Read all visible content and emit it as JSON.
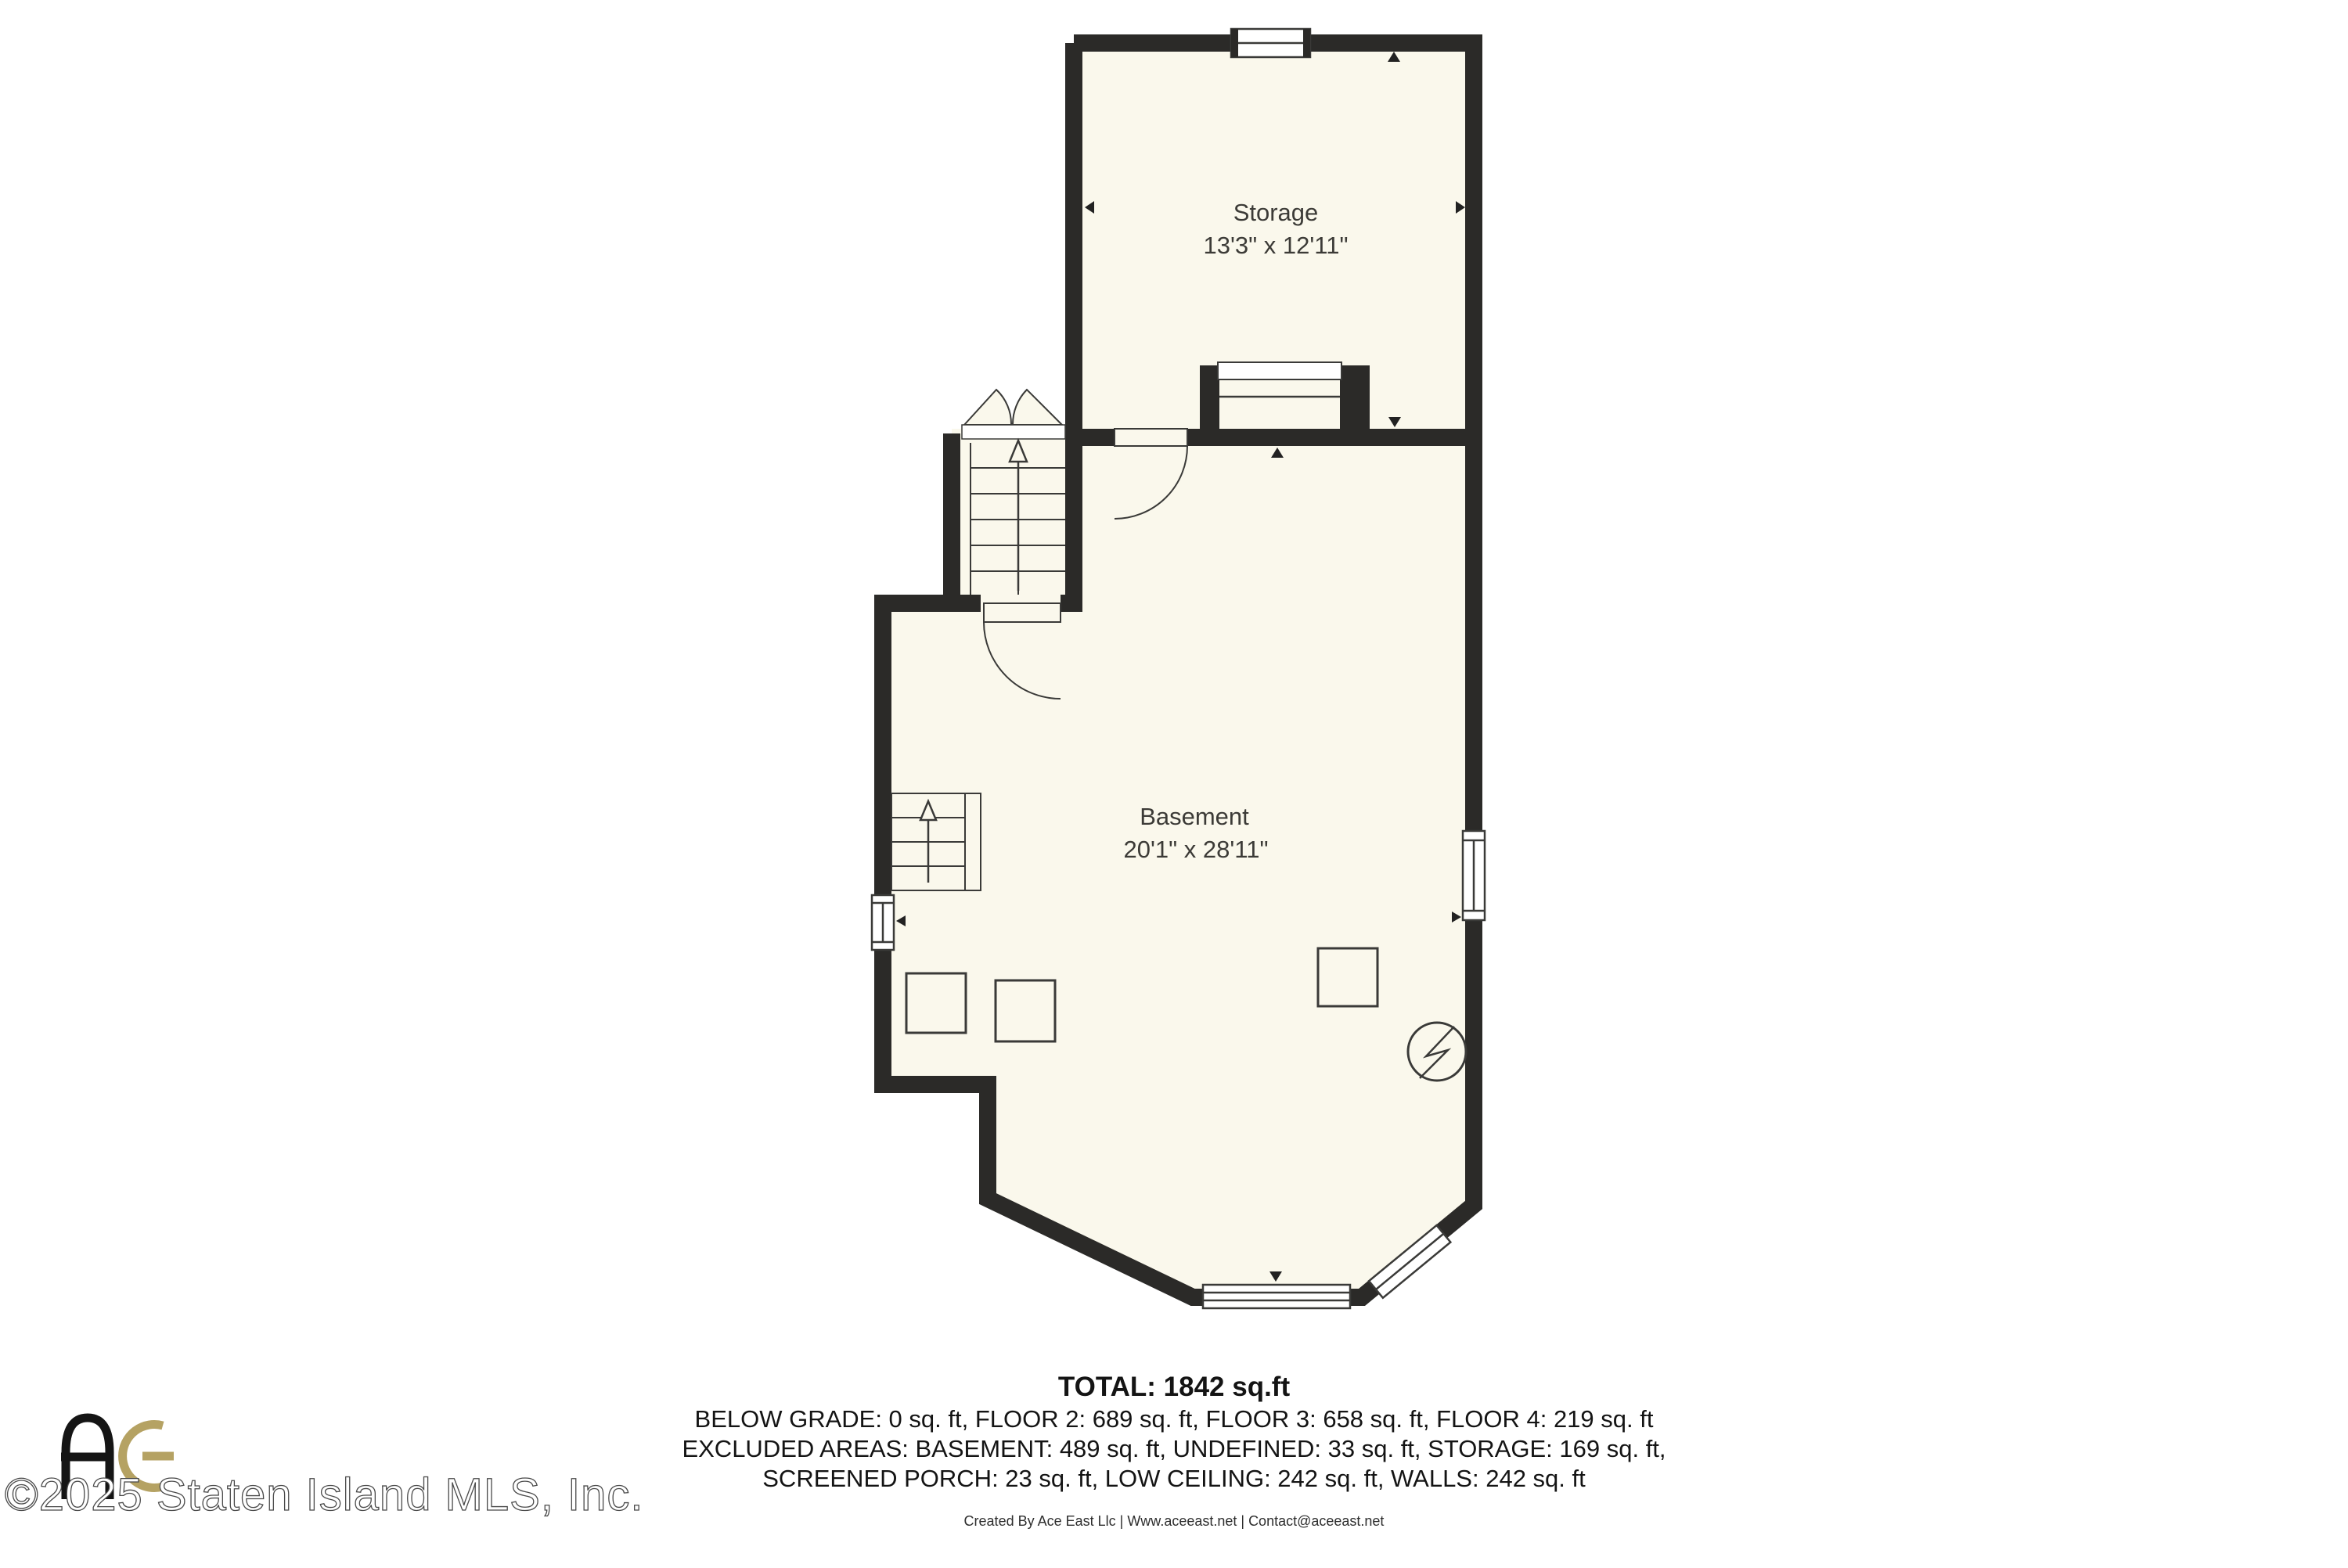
{
  "floor_plan": {
    "rooms": [
      {
        "name": "Storage",
        "dimensions": "13'3\" x 12'11\""
      },
      {
        "name": "Basement",
        "dimensions": "20'1\" x 28'11\""
      }
    ],
    "wall_color": "#2b2a28",
    "floor_color": "#faf8ec",
    "symbols": [
      "window",
      "door-swing",
      "double-door-swing",
      "stairs-up-arrow",
      "column-post",
      "utility-circle-bolt",
      "direction-marker"
    ]
  },
  "summary": {
    "total": "TOTAL: 1842 sq.ft",
    "line_1": "BELOW GRADE: 0 sq. ft, FLOOR 2: 689 sq. ft, FLOOR 3: 658 sq. ft, FLOOR 4: 219 sq. ft",
    "line_2": "EXCLUDED AREAS: BASEMENT: 489 sq. ft, UNDEFINED: 33 sq. ft, STORAGE: 169 sq. ft,",
    "line_3": "SCREENED PORCH: 23 sq. ft, LOW CEILING: 242 sq. ft, WALLS: 242 sq. ft"
  },
  "footer": {
    "credit": "Created By Ace East Llc | Www.aceeast.net | Contact@aceeast.net"
  },
  "watermark": {
    "text": "©2025 Staten Island MLS, Inc.",
    "logo_monogram": "AE",
    "logo_black": "#151515",
    "logo_gold": "#b5a263"
  }
}
